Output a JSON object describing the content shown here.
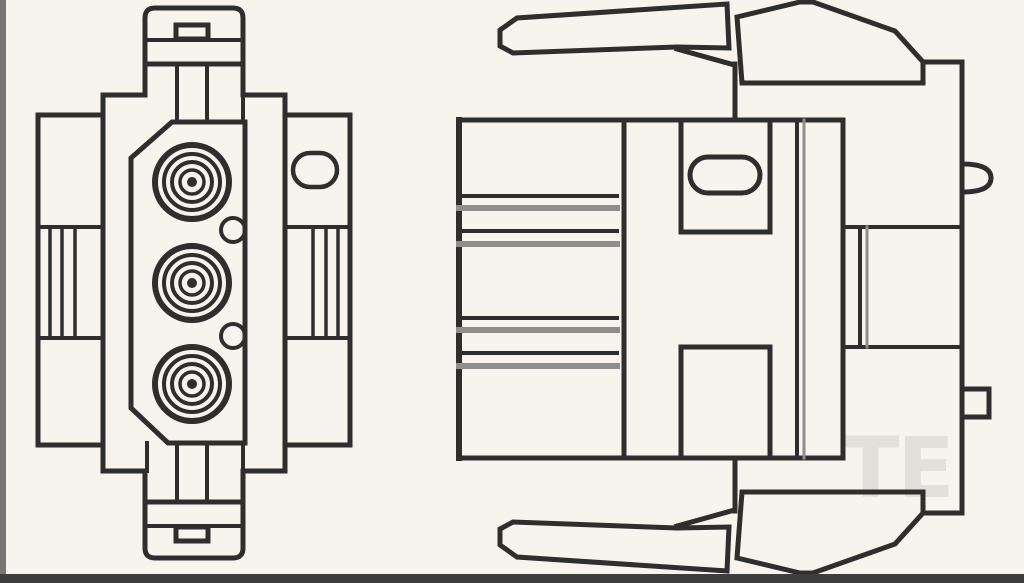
{
  "canvas": {
    "width": 1024,
    "height": 583
  },
  "colors": {
    "background": "#f7f4ee",
    "line": "#2e2e2e",
    "line_gray": "#8e8e8e",
    "frame_left": "#767676",
    "frame_bottom": "#3e3e3e",
    "watermark": "rgba(45,45,45,0.10)"
  },
  "watermark": {
    "text": "TE"
  },
  "drawing": {
    "type": "technical-line-drawing",
    "views": [
      {
        "name": "front-view",
        "contact_cavities": 3,
        "keying_notches": 2,
        "oval_slots": 1
      },
      {
        "name": "side-view",
        "latch_arms": 2,
        "oval_windows": 1,
        "seal_rib_groups": 2
      }
    ]
  }
}
